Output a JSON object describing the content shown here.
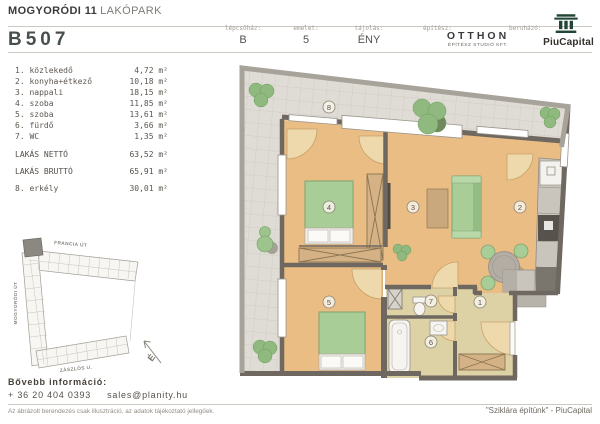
{
  "header": {
    "project_title_bold": "MOGYORÓDI 11",
    "project_title_light": "LAKÓPARK",
    "unit_id": "B507",
    "stats": [
      {
        "label": "lépcsőház:",
        "value": "B"
      },
      {
        "label": "emelet:",
        "value": "5"
      },
      {
        "label": "tájolás:",
        "value": "ÉNY"
      }
    ],
    "architect": {
      "label": "építész:",
      "name": "OTTHON",
      "subname": "ÉPÍTÉSZ STUDIÓ KFT."
    },
    "developer": {
      "label": "beruházó:",
      "brand": "PiuCapital",
      "logo_icon": "classical-column-icon"
    }
  },
  "room_list": {
    "rooms": [
      {
        "label": "1. közlekedő",
        "area": "4,72 m²"
      },
      {
        "label": "2. konyha+étkező",
        "area": "10,18 m²"
      },
      {
        "label": "3. nappali",
        "area": "18,15 m²"
      },
      {
        "label": "4. szoba",
        "area": "11,85 m²"
      },
      {
        "label": "5. szoba",
        "area": "13,61 m²"
      },
      {
        "label": "6. fürdő",
        "area": "3,66 m²"
      },
      {
        "label": "7. WC",
        "area": "1,35 m²"
      }
    ],
    "totals": [
      {
        "label": "LAKÁS NETTÓ",
        "area": "63,52 m²"
      },
      {
        "label": "LAKÁS BRUTTÓ",
        "area": "65,91 m²"
      }
    ],
    "balcony": {
      "label": "8. erkély",
      "area": "30,01 m²"
    }
  },
  "site_map": {
    "street_top": "FRANCIA ÚT",
    "street_left": "MOGYORÓDI ÚT",
    "street_bottom": "ZÁSZLÓS U.",
    "north_letter": "É"
  },
  "floor_plan": {
    "labels": [
      "1",
      "2",
      "3",
      "4",
      "5",
      "6",
      "7",
      "8"
    ]
  },
  "contact": {
    "heading": "Bővebb információ:",
    "phone": "+ 36 20 404 0393",
    "email": "sales@planity.hu"
  },
  "disclaimer": "Az ábrázolt berendezés csak illusztráció, az adatok tájékoztató jellegűek.",
  "footer_note": "\"Sziklára építünk\" - PiuCapital",
  "colors": {
    "furniture_green": "#a9cd97",
    "floor_orange": "#eabd85",
    "floor_beige": "#ddd1a6",
    "balcony_tile_gray": "#dfdcd5",
    "wall_gray": "#6f6861",
    "logo_green": "#234536"
  }
}
